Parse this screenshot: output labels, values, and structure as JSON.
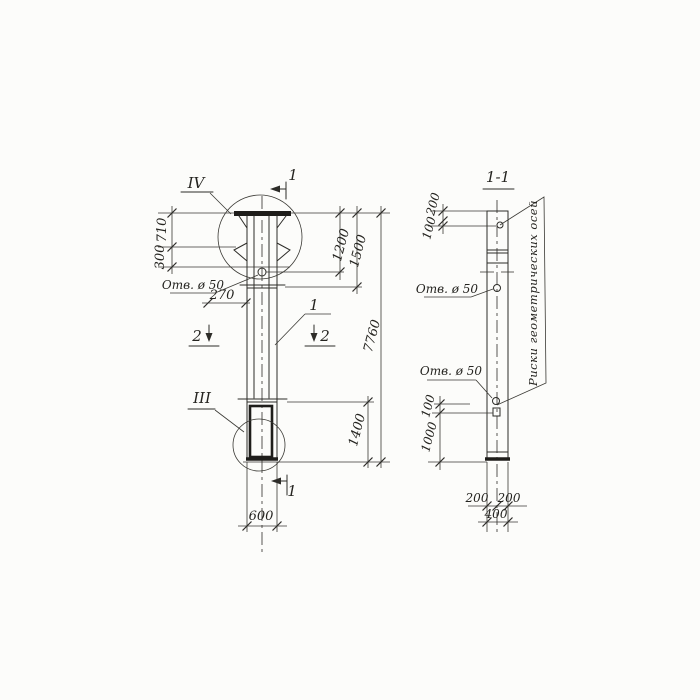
{
  "colors": {
    "ink": "#2d2c28",
    "paper": "#fcfcfa"
  },
  "front": {
    "detail_top": "IV",
    "detail_bottom": "III",
    "section1": "1",
    "section2": "2",
    "callout": "1",
    "hole_label": "Отв. ø 50",
    "dims": {
      "d710": "710",
      "d300": "300",
      "d270": "270",
      "d1200": "1200",
      "d1500": "1500",
      "d7760": "7760",
      "d1400": "1400",
      "d600": "600"
    }
  },
  "section": {
    "title": "1-1",
    "hole_label": "Отв. ø 50",
    "axis_note": "Риски геометрических осей",
    "dims": {
      "d200_top": "200",
      "d100_top": "100",
      "d100_bottom": "100",
      "d1000": "1000",
      "d200_left": "200",
      "d200_right": "200",
      "d400": "400"
    }
  }
}
